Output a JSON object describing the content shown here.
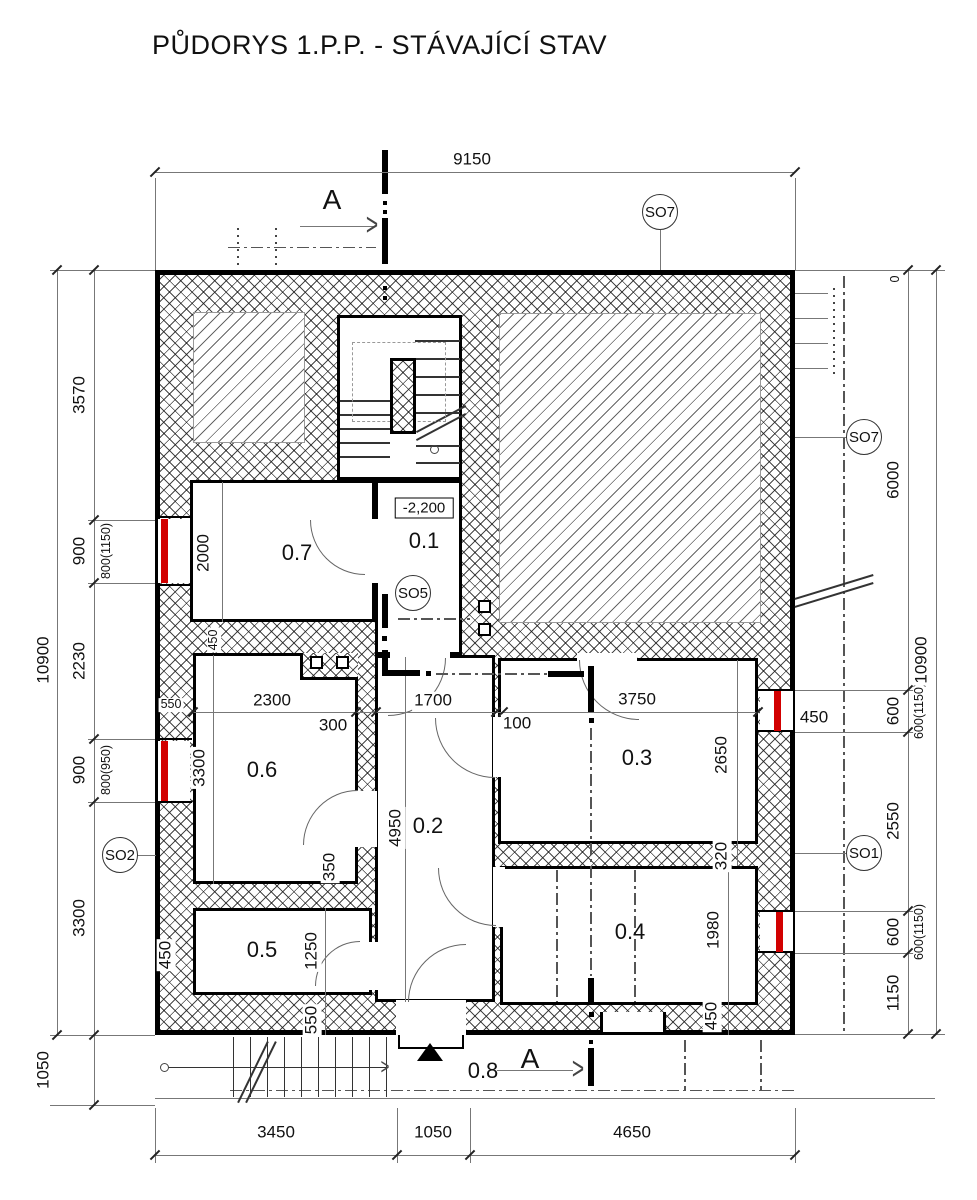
{
  "title": "PŮDORYS 1.P.P. - STÁVAJÍCÍ STAV",
  "section": {
    "label": "A"
  },
  "level_marker": "-2,200",
  "markers": {
    "so1": "SO1",
    "so2": "SO2",
    "so5": "SO5",
    "so7": "SO7"
  },
  "rooms": {
    "r01": "0.1",
    "r02": "0.2",
    "r03": "0.3",
    "r04": "0.4",
    "r05": "0.5",
    "r06": "0.6",
    "r07": "0.7",
    "r08": "0.8"
  },
  "dims": {
    "t9150": "9150",
    "l10900": "10900",
    "l3570": "3570",
    "l900a": "900",
    "l900a_s": "800(1150)",
    "l2230": "2230",
    "l900b": "900",
    "l900b_s": "800(950)",
    "l3300": "3300",
    "l1050": "1050",
    "r0": "0",
    "r10900": "10900",
    "r6000": "6000",
    "r600a": "600",
    "r600a_s": "600(1150)",
    "r2550": "2550",
    "r600b": "600",
    "r600b_s": "600(1150)",
    "r1150": "1150",
    "r450": "450",
    "b3450": "3450",
    "b1050": "1050",
    "b4650": "4650",
    "i2000": "2000",
    "i450tl": "450",
    "i550l": "550",
    "i2300": "2300",
    "i300": "300",
    "i1700": "1700",
    "i100": "100",
    "i3300": "3300",
    "i350": "350",
    "i4950": "4950",
    "i3750": "3750",
    "i2650": "2650",
    "i320": "320",
    "i1980": "1980",
    "i450r": "450",
    "i1250": "1250",
    "i550b": "550",
    "i450bl": "450"
  }
}
